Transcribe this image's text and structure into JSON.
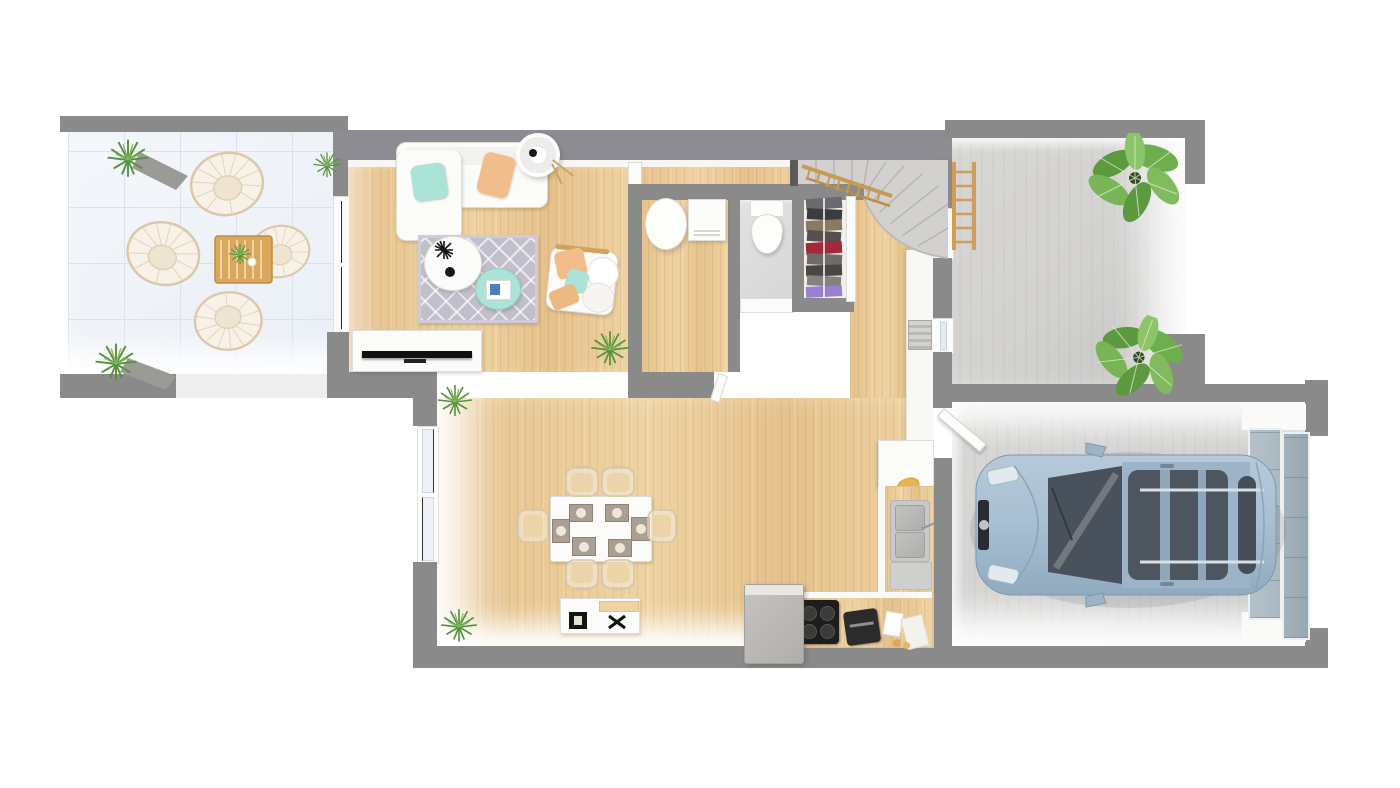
{
  "image": {
    "kind": "3d-rendered-floor-plan-top-view",
    "description": "Top-down 3D architectural rendering of a single-storey house ground floor with terrace, living-dining room, open kitchen, utility room, WC, closet, winder staircase, entry courtyard and a garage containing a light blue car. No text labels are rendered in the image."
  },
  "palette": {
    "wall": "#8a8a8a",
    "wall_mauve": "#8d8c93",
    "wall_dark": "#5a5a5c",
    "wall_face": "#f7f6f3",
    "wood": "#e5c18b",
    "wood_light": "#efd3a3",
    "wood_dark": "#d8b074",
    "terrace_tile": "#eef2f8",
    "terrace_line": "#d9e2ee",
    "concrete": "#d3d2d0",
    "concrete_dark": "#c4c3c1",
    "wc_tile": "#d7d7d7",
    "white_furn": "#fbfbf9",
    "furn_border": "#e0ded8",
    "mint": "#abe3d6",
    "peach": "#f2bd8d",
    "accent_wood": "#d3a05f",
    "rail_wood": "#c79b55",
    "rug": "#c2bfcd",
    "plant": "#5d9a3f",
    "plant_light": "#82bb5e",
    "car_body": "#a7bfd2",
    "car_body2": "#90aac0",
    "car_glass": "#4b545c",
    "car_trim": "#dde3e8",
    "garage_door": "#aab9c2",
    "steel": "#c9c9c7",
    "steel_dark": "#aeaeac",
    "ink": "#1c1c1c",
    "cloth_red": "#a2293a",
    "cloth_purple": "#9a7fd0"
  },
  "rooms": [
    {
      "id": "terrace",
      "floor": "light blue-white tile",
      "contents": [
        "4 wicker lounge chairs",
        "slatted wood coffee table",
        "2 potted plants",
        "small plant"
      ]
    },
    {
      "id": "living-room",
      "floor": "light oak plank",
      "contents": [
        "white sofa with mint and peach pillows",
        "white floor lamp",
        "patterned gray rug",
        "round white coffee table",
        "mint side table with book",
        "white armchair with cushions",
        "tv stand with tv",
        "houseplant"
      ]
    },
    {
      "id": "dining-area",
      "floor": "light oak plank",
      "contents": [
        "white dining table with 6 place settings",
        "6 ghost chairs",
        "white sideboard with 2 black objects",
        "2 small plants"
      ]
    },
    {
      "id": "kitchen",
      "floor": "light oak plank",
      "contents": [
        "L-shaped counter",
        "double sink",
        "4-burner stove",
        "fridge cabinet",
        "coffee machine",
        "wall cabinet column",
        "radiator"
      ]
    },
    {
      "id": "utility-room",
      "floor": "light oak plank",
      "contents": [
        "water heater",
        "washing machine"
      ]
    },
    {
      "id": "wc",
      "floor": "gray tile",
      "contents": [
        "toilet"
      ]
    },
    {
      "id": "closet",
      "floor": "white",
      "contents": [
        "clothes rail with hanging garments",
        "sliding door"
      ]
    },
    {
      "id": "staircase",
      "floor": "concrete",
      "contents": [
        "winder stairs",
        "wood railing"
      ]
    },
    {
      "id": "entry-courtyard",
      "floor": "concrete",
      "contents": [
        "wood ladder shelf",
        "2 large leafy plants"
      ]
    },
    {
      "id": "garage",
      "floor": "concrete",
      "contents": [
        "light blue estate car",
        "sectional garage door",
        "door to house"
      ]
    }
  ]
}
